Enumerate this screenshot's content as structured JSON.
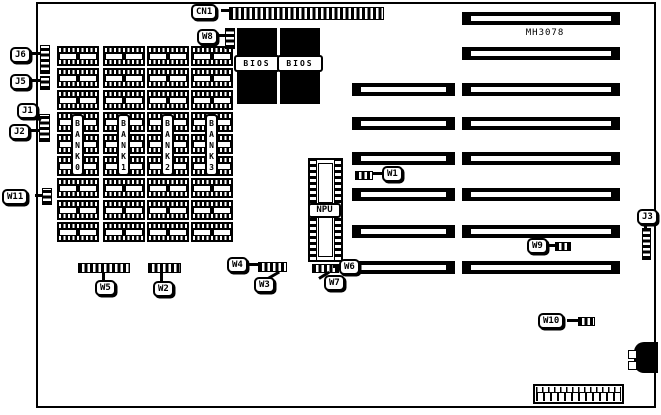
{
  "diagram": {
    "part_number": "MH3078",
    "connector_labels": {
      "cn1": "CN1",
      "w8": "W8",
      "j6": "J6",
      "j5": "J5",
      "j1": "J1",
      "j2": "J2",
      "w11": "W11",
      "w1": "W1",
      "w9": "W9",
      "j3": "J3",
      "w6": "W6",
      "w7": "W7",
      "w5": "W5",
      "w2": "W2",
      "w4": "W4",
      "w3": "W3",
      "w10": "W10"
    },
    "chips": {
      "bios_1": "BIOS",
      "bios_2": "BIOS",
      "npu": "NPU"
    },
    "memory_banks": {
      "bank0": "BANK0",
      "bank1": "BANK1",
      "bank2": "BANK2",
      "bank3": "BANK3"
    }
  }
}
